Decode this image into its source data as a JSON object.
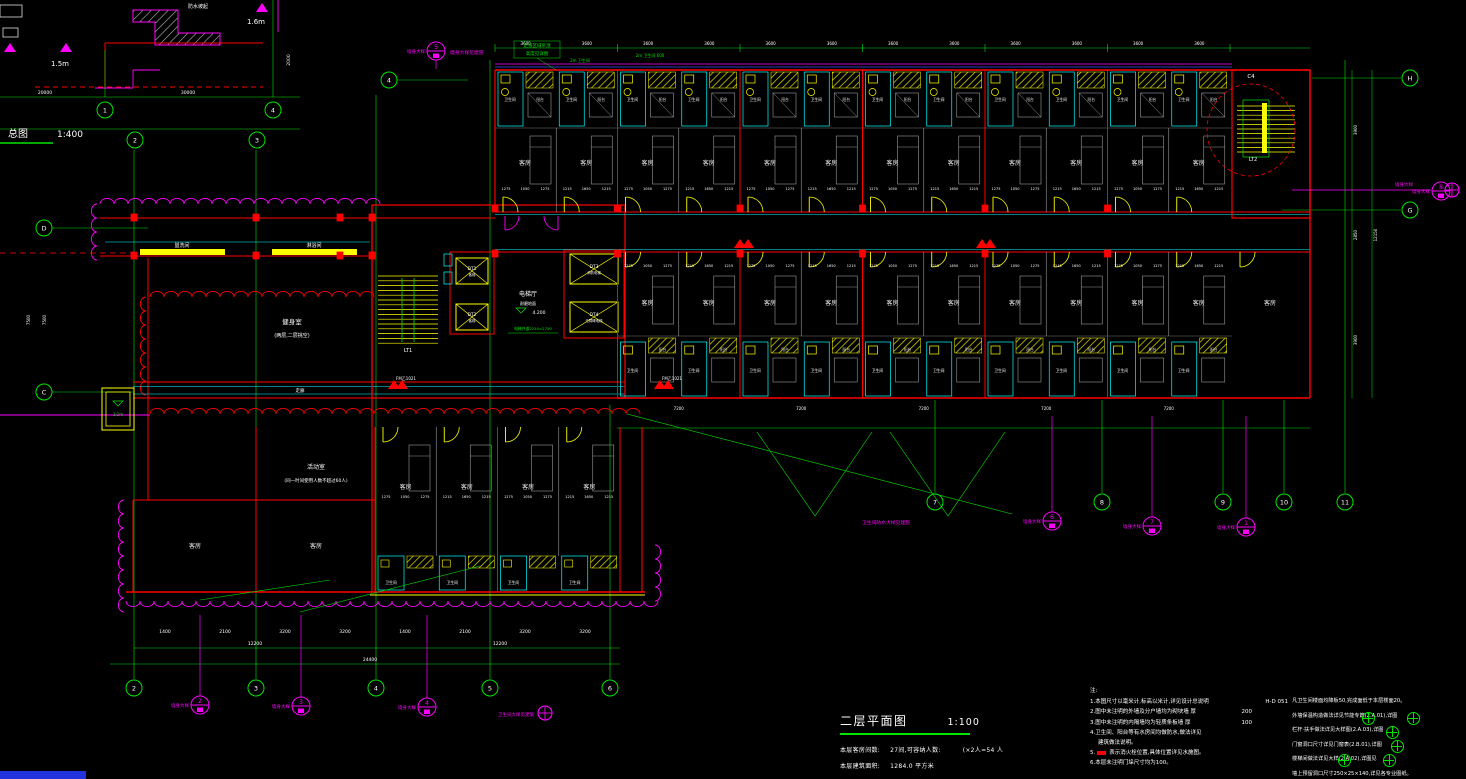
{
  "colors": {
    "green": "#00e400",
    "red": "#ff0000",
    "magenta": "#ff00ff",
    "cyan": "#00ffff",
    "yellow": "#ffff00",
    "white": "#ffffff",
    "grey": "#9a9a9a",
    "blue": "#4444ff"
  },
  "site_detail": {
    "label": "总图",
    "scale": "1:400",
    "note": "防水坡起",
    "levels": [
      "1.5m",
      "1.6m"
    ]
  },
  "plan": {
    "room_label": "客房",
    "bath_label": "卫生间",
    "balcony_label": "阳台",
    "corridor_note1": "走道区域吊顶",
    "corridor_note2": "高度见详图",
    "bath_note1": "2m 卫生间",
    "bath_note2": "2m 卫生间 600",
    "corridor_label": "走廊",
    "fm_label": "FM乙1021",
    "leader_note": "卫生间防水大样见建施",
    "target_note": "卫生间大样见建施",
    "shaft_level": "1.2m",
    "stair1": "LT1",
    "stair2": "LT2",
    "c4": "C4",
    "elev": {
      "hall": "电梯厅",
      "floor": "耐磨地面",
      "level": "4.200",
      "note": "电梯井道2250×2750",
      "cars": [
        {
          "id": "DT1",
          "sub": "客梯"
        },
        {
          "id": "DT2",
          "sub": "客梯"
        },
        {
          "id": "DT3",
          "sub": "消防电梯"
        },
        {
          "id": "DT4",
          "sub": "无障碍电梯"
        }
      ]
    },
    "room1": {
      "name": "健身室",
      "sub": "(两层,二层挑空)"
    },
    "room2": {
      "name": "活动室",
      "sub": "(同一时间使用人数不超过60人)"
    },
    "strip_rooms": [
      "盥洗间",
      "淋浴间"
    ],
    "dims": {
      "module": [
        "1275",
        "1050",
        "1275"
      ],
      "module_alt": [
        "1215",
        "1650",
        "1215"
      ],
      "top": "3600",
      "wing_bottom": "7200",
      "right_edge": [
        "3900",
        "2850",
        "3900",
        "12150"
      ],
      "bottom_row1": [
        "1400",
        "2100",
        "3200",
        "3200",
        "1400",
        "2100",
        "3200",
        "3200"
      ],
      "bottom_row2": [
        "12200",
        "12200"
      ],
      "bottom_total": "24400",
      "left_edge": [
        "7500",
        "7500"
      ],
      "site": [
        "20000",
        "30000"
      ],
      "site_side": "2000"
    }
  },
  "grid": {
    "bottom_bubbles": [
      {
        "x": 134,
        "label": "2"
      },
      {
        "x": 256,
        "label": "3"
      },
      {
        "x": 376,
        "label": "4"
      },
      {
        "x": 490,
        "label": "5"
      },
      {
        "x": 610,
        "label": "6"
      }
    ],
    "wing_bubbles": [
      {
        "x": 935,
        "label": "7"
      },
      {
        "x": 1102,
        "label": "8"
      },
      {
        "x": 1223,
        "label": "9"
      },
      {
        "x": 1284,
        "label": "10"
      },
      {
        "x": 1345,
        "label": "11"
      }
    ],
    "right_bubbles": [
      {
        "y": 78,
        "label": "H"
      },
      {
        "y": 210,
        "label": "G"
      }
    ],
    "left_bubbles": [
      {
        "y": 228,
        "label": "D"
      },
      {
        "y": 392,
        "label": "C"
      }
    ],
    "top_bubble": {
      "x": 389,
      "y": 80,
      "label": "4"
    },
    "site_bubbles": [
      {
        "x": 105,
        "y": 110,
        "label": "1"
      },
      {
        "x": 273,
        "y": 110,
        "label": "4"
      },
      {
        "x": 135,
        "y": 140,
        "label": "2"
      },
      {
        "x": 257,
        "y": 140,
        "label": "3"
      }
    ]
  },
  "callouts": {
    "label": "墙身大样",
    "top": {
      "x": 436,
      "y": 51,
      "num": "5",
      "note": "墙身大样见建施"
    },
    "items": [
      {
        "x": 200,
        "y": 705,
        "num": "2"
      },
      {
        "x": 301,
        "y": 706,
        "num": "3"
      },
      {
        "x": 427,
        "y": 707,
        "num": "4"
      },
      {
        "x": 1052,
        "y": 521,
        "num": "6"
      },
      {
        "x": 1152,
        "y": 526,
        "num": "7"
      },
      {
        "x": 1246,
        "y": 527,
        "num": "1"
      },
      {
        "x": 1441,
        "y": 191,
        "num": "8"
      }
    ]
  },
  "title_block": {
    "title": "二层平面图",
    "scale": "1:100",
    "stat1_label": "本层客房间数:",
    "stat1_value": "27间,可容纳人数:",
    "stat1_extra": "(×2人=54 人",
    "stat2_label": "本层建筑面积:",
    "stat2_value": "1284.0 平方米"
  },
  "notes": {
    "left": {
      "heading": "注:",
      "items": [
        {
          "n": "1.",
          "t": "本图尺寸以毫米计,标高以米计,详见设计总说明",
          "tail": "H-D 051"
        },
        {
          "n": "2.",
          "t": "图中未注明的外墙及分户墙均为砌块墙  厚",
          "tail": "200",
          "mr": 36
        },
        {
          "n": "3.",
          "t": "图中未注明的内隔墙均为轻质条板墙  厚",
          "tail": "100",
          "mr": 36
        },
        {
          "n": "4.",
          "t": "卫生间、阳台等有水房间均做防水,做法详见"
        },
        {
          "n": "",
          "t": "建筑做法说明。",
          "ind": true
        },
        {
          "n": "5.",
          "sym": true,
          "t": "表示消火栓位置,具体位置详见水施图。"
        },
        {
          "n": "6.",
          "t": "本层未注明门垛尺寸均为100。"
        }
      ]
    },
    "right": {
      "items": [
        "凡卫生间楼面均降板50,完成面低于本层楼面20。",
        "外墙保温构造做法详见节能专篇(2.A.01),详图",
        "栏杆·扶手做法详见大样图(2.A.03),详图",
        "门窗洞口尺寸详见门窗表(2.B.01),详图",
        "楼梯间做法详见大样(2.A.02),详图见",
        "墙上预留洞口尺寸250×25×140,详见各专业图纸。"
      ]
    }
  }
}
